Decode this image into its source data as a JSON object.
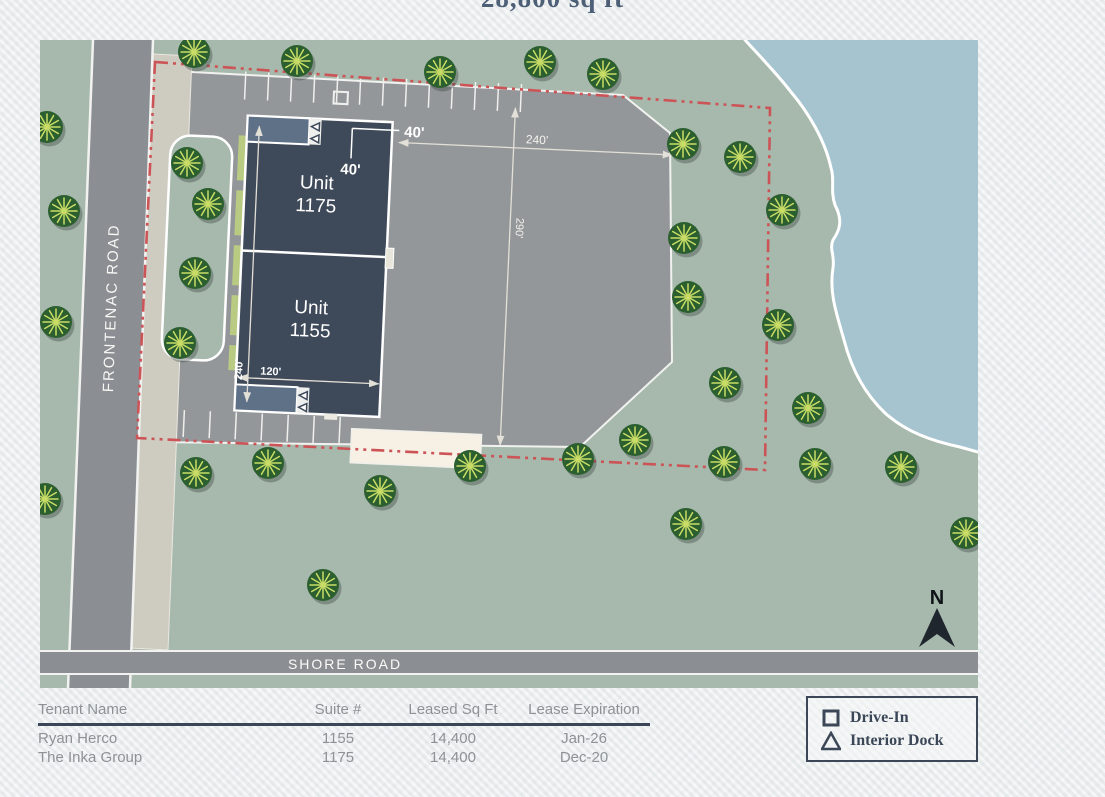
{
  "title": "28,800 sq ft",
  "map": {
    "roads": {
      "frontenac": "FRONTENAC ROAD",
      "shore": "SHORE ROAD"
    },
    "units": [
      {
        "line1": "Unit",
        "line2": "1175"
      },
      {
        "line1": "Unit",
        "line2": "1155"
      }
    ],
    "dimensions": {
      "d40_a": "40'",
      "d40_b": "40'",
      "d240_building": "240'",
      "d120": "120'",
      "d240_lot": "240'",
      "d290": "290'"
    },
    "north_label": "N"
  },
  "table": {
    "headers": [
      "Tenant Name",
      "Suite #",
      "Leased Sq Ft",
      "Lease Expiration"
    ],
    "rows": [
      [
        "Ryan Herco",
        "1155",
        "14,400",
        "Jan-26"
      ],
      [
        "The Inka Group",
        "1175",
        "14,400",
        "Dec-20"
      ]
    ]
  },
  "legend": {
    "items": [
      {
        "icon": "square",
        "label": "Drive-In"
      },
      {
        "icon": "triangle",
        "label": "Interior Dock"
      }
    ]
  },
  "colors": {
    "building": "#3e4959",
    "dock": "#5e7187",
    "water": "#a5c4d0",
    "grass": "#a6b9ac",
    "road": "#8b8f93",
    "parking": "#94979a",
    "boundary_red": "#cc5457",
    "pad_cream": "#f7f1e5",
    "accent_dark": "#3b4757",
    "table_text": "#8e9295",
    "tree_dark": "#2b5f2f",
    "tree_light": "#c9dd66"
  }
}
